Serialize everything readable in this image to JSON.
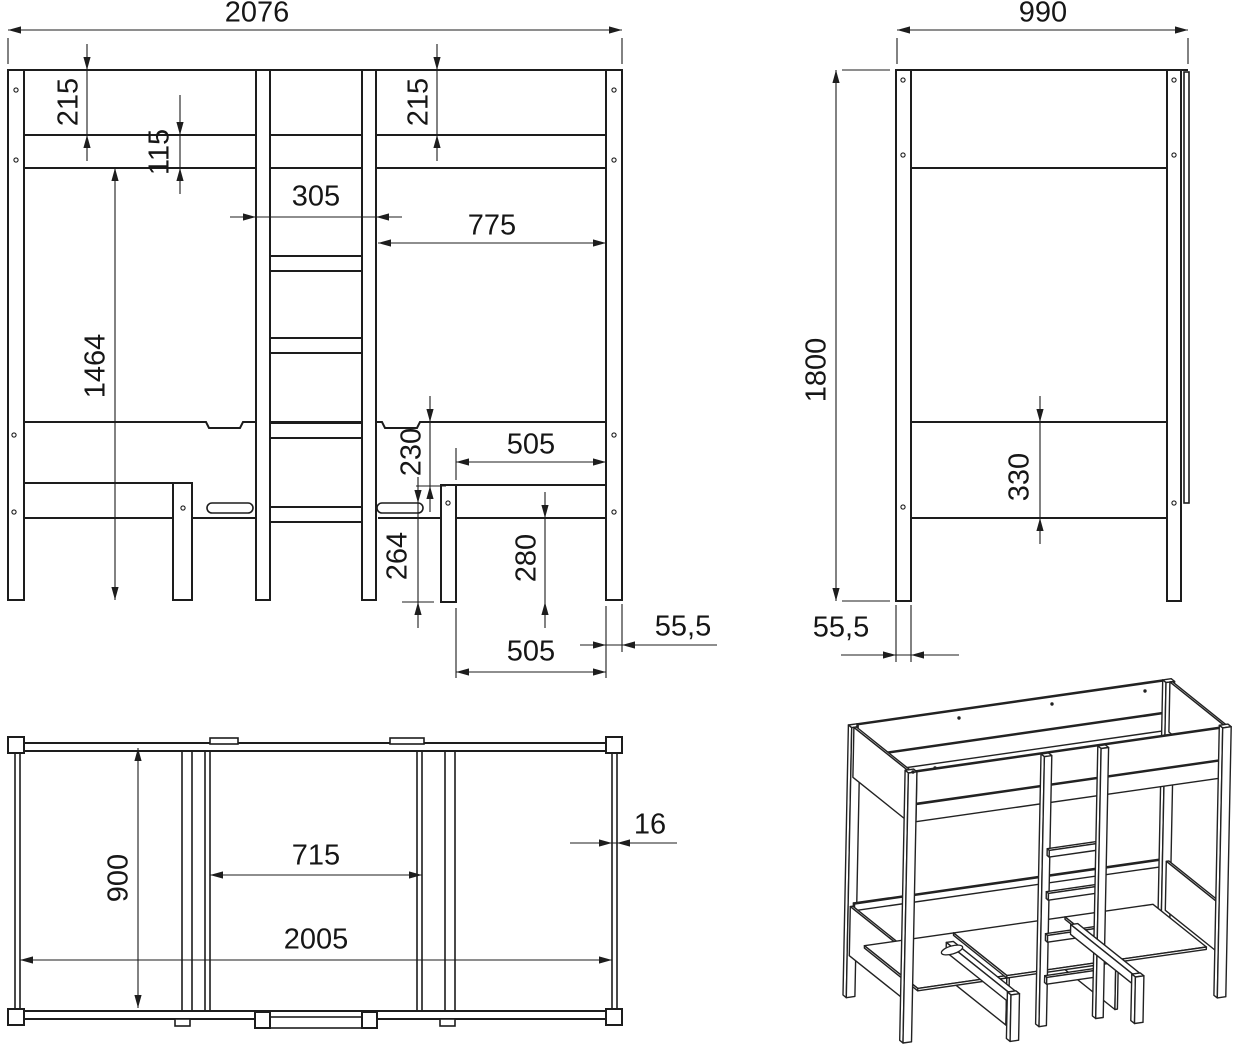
{
  "sheet": {
    "type": "furniture technical drawing",
    "background": "#ffffff",
    "line_color": "#1d1d1d",
    "dim_color": "#1d1d1d"
  },
  "views": {
    "front": {
      "name": "front-elevation",
      "dims": {
        "overall_width": "2076",
        "top_rail_height": "215",
        "mid_rail_height": "115",
        "top_rail_height_right": "215",
        "ladder_width": "305",
        "right_opening_width": "775",
        "underside_height": "1464",
        "rail_to_desk_drop": "230",
        "bench_opening_top": "505",
        "desk_surface_height": "264",
        "bench_leg_height": "280",
        "bench_opening_bottom": "505",
        "post_width": "55,5"
      }
    },
    "side": {
      "name": "side-elevation",
      "dims": {
        "overall_depth": "990",
        "overall_height": "1800",
        "lower_panel_height": "330",
        "post_depth": "55,5"
      }
    },
    "plan": {
      "name": "plan-view",
      "dims": {
        "inner_depth": "900",
        "desk_opening_width": "715",
        "inner_length": "2005",
        "board_thickness": "16"
      }
    },
    "iso": {
      "name": "perspective-view"
    }
  }
}
